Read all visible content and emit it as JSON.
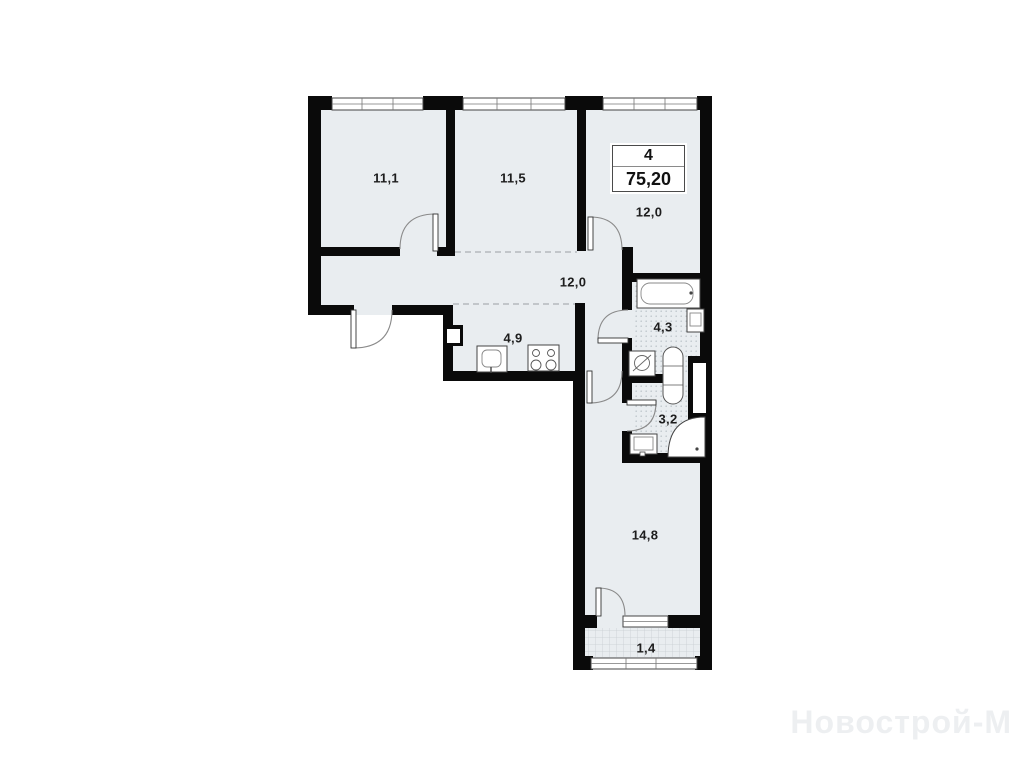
{
  "unit_info": {
    "rooms_count": "4",
    "total_area": "75,20"
  },
  "room_areas": {
    "bedroom_1": "11,1",
    "bedroom_2": "11,5",
    "bedroom_3": "12,0",
    "hallway": "12,0",
    "kitchen": "4,9",
    "bathroom": "4,3",
    "shower_room": "3,2",
    "living_room": "14,8",
    "balcony": "1,4"
  },
  "watermark": "Новострой-М",
  "colors": {
    "floor_fill": "#e9edf0",
    "wall": "#0a0a0a",
    "tile_dot": "#bfc6cc",
    "balcony_grid": "#c8cdd2",
    "door_arc": "#8a8a8a",
    "watermark_text": "#edeff1"
  }
}
